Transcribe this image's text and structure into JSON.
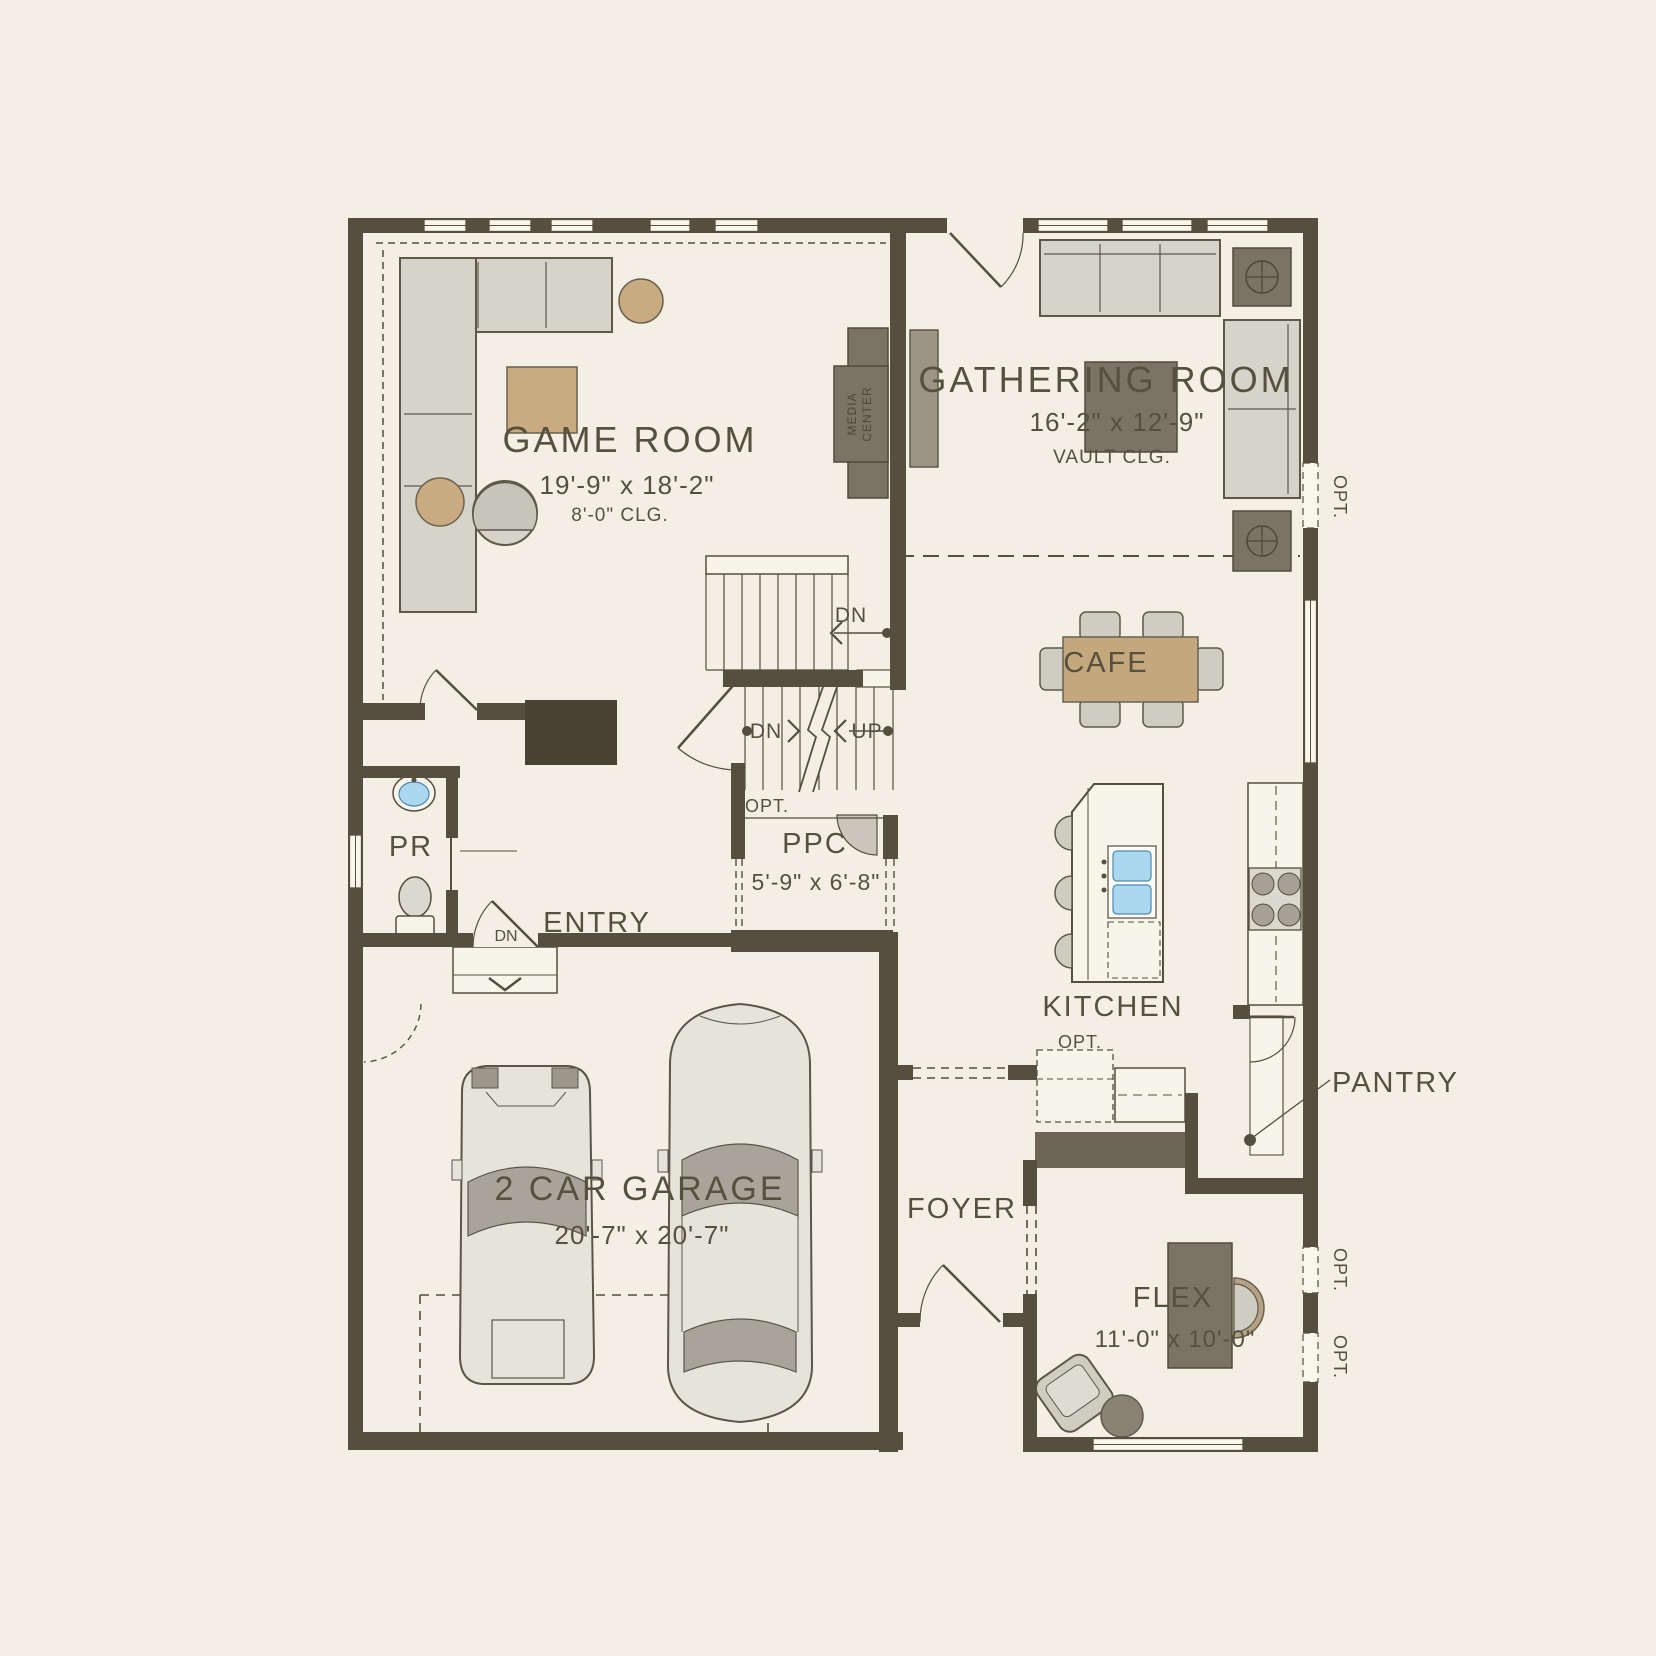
{
  "plan": {
    "rooms": {
      "game_room": {
        "label": "GAME ROOM",
        "dims": "19'-9\" x 18'-2\"",
        "ceiling": "8'-0\" CLG."
      },
      "gathering_room": {
        "label": "GATHERING ROOM",
        "dims": "16'-2\" x 12'-9\"",
        "ceiling": "VAULT CLG."
      },
      "cafe": {
        "label": "CAFE"
      },
      "kitchen": {
        "label": "KITCHEN"
      },
      "pantry": {
        "label": "PANTRY"
      },
      "foyer": {
        "label": "FOYER"
      },
      "entry": {
        "label": "ENTRY"
      },
      "powder_room": {
        "label": "PR"
      },
      "ppc": {
        "label": "PPC",
        "dims": "5'-9\" x 6'-8\""
      },
      "garage": {
        "label": "2 CAR GARAGE",
        "dims": "20'-7\" x 20'-7\""
      },
      "flex": {
        "label": "FLEX",
        "dims": "11'-0\" x 10'-0\""
      }
    },
    "annotations": {
      "opt": "OPT.",
      "dn": "DN",
      "up": "UP",
      "media_line1": "MEDIA",
      "media_line2": "CENTER"
    },
    "colors": {
      "background": "#f3efe4",
      "wall": "#564e3e",
      "furniture_gray": "#d6d3ca",
      "furniture_tan": "#c8ab80",
      "furniture_dark": "#7b7365",
      "sink_blue": "#aad8f0",
      "text": "#57503f"
    }
  }
}
